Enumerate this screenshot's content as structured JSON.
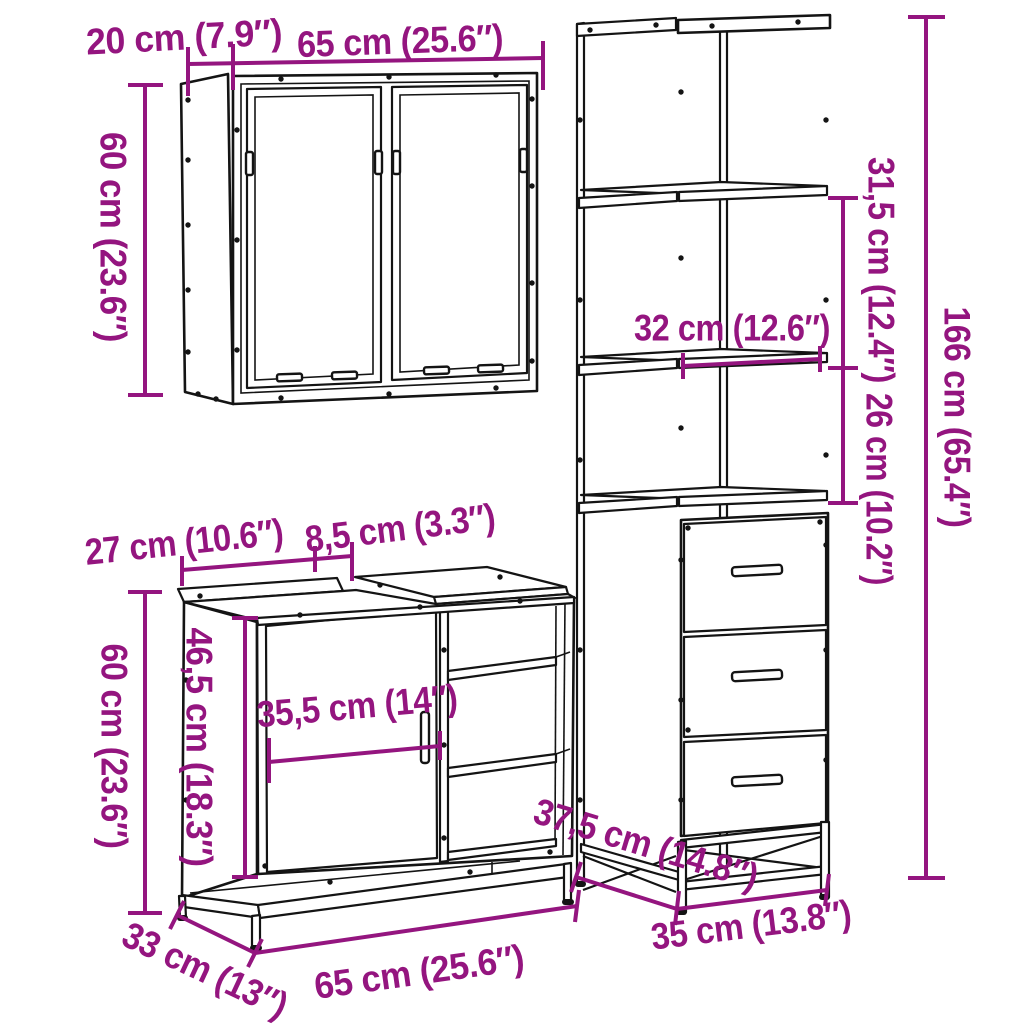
{
  "colors": {
    "background": "#ffffff",
    "line": "#141414",
    "dimension_accent": "#94157f"
  },
  "pieces": {
    "wall_cabinet": {
      "dims": {
        "depth": "20 cm (7.9″)",
        "width": "65 cm (25.6″)",
        "height": "60 cm (23.6″)"
      }
    },
    "tall_cabinet": {
      "dims": {
        "upper_section_height": "31,5 cm (12.4″)",
        "shelf_width": "32 cm (12.6″)",
        "middle_section_height": "26 cm (10.2″)",
        "height": "166 cm (65.4″)",
        "depth": "37,5 cm (14.8″)",
        "width": "35 cm (13.8″)"
      }
    },
    "vanity_cabinet": {
      "dims": {
        "top_rear_width": "27 cm (10.6″)",
        "top_notch_width": "8,5 cm (3.3″)",
        "height": "60 cm (23.6″)",
        "inner_height": "46,5 cm (18.3″)",
        "door_width": "35,5 cm (14″)",
        "depth": "33 cm (13″)",
        "width": "65 cm (25.6″)"
      }
    }
  }
}
